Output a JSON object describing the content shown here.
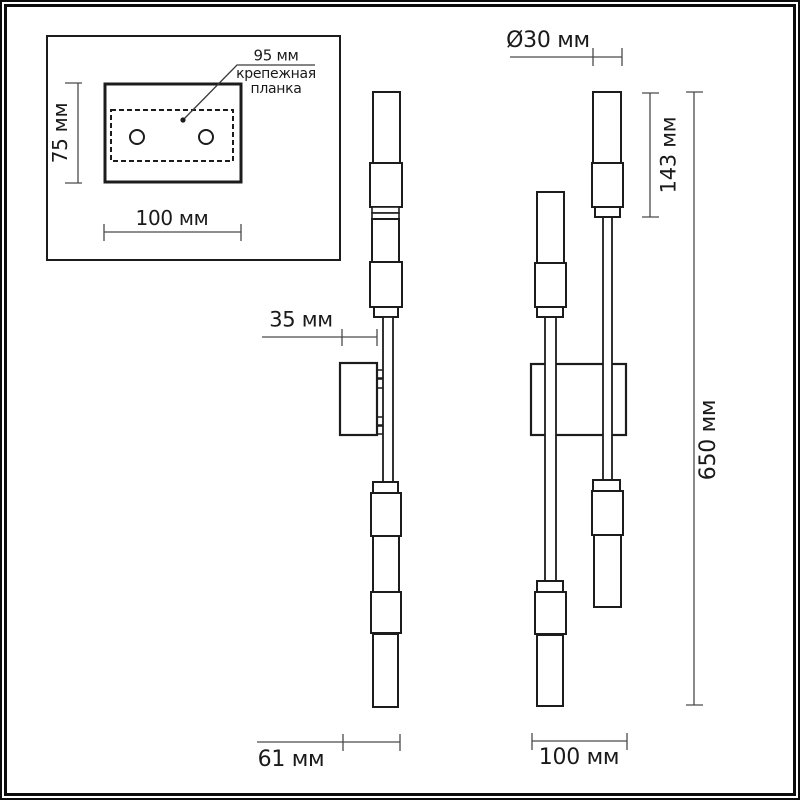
{
  "colors": {
    "ink": "#1c1c1c",
    "dimension_line": "#4a4a4a",
    "text": "#1a1a1a",
    "background": "#ffffff"
  },
  "inset": {
    "hole_spacing_label": "95 мм",
    "plate_label_line1": "крепежная",
    "plate_label_line2": "планка",
    "height_label": "75 мм",
    "width_label": "100 мм"
  },
  "side_view": {
    "wall_offset_label": "35 мм",
    "depth_label": "61 мм"
  },
  "front_view": {
    "diameter_label": "Ø30 мм",
    "shade_height_label": "143 мм",
    "total_height_label": "650 мм",
    "width_label": "100 мм"
  }
}
